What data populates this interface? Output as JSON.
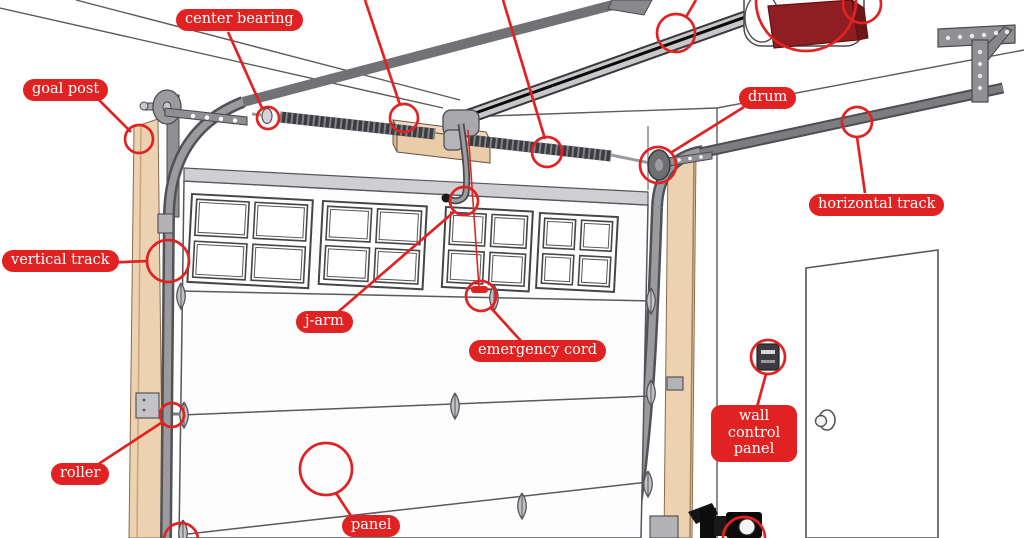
{
  "diagram": {
    "type": "annotated-parts-illustration",
    "labels": {
      "goal_post": "goal post",
      "center_bearing": "center bearing",
      "drum": "drum",
      "horizontal_track": "horizontal track",
      "vertical_track": "vertical track",
      "j_arm": "j-arm",
      "emergency_cord": "emergency cord",
      "roller": "roller",
      "wall_control_panel": "wall control panel",
      "panel": "panel"
    },
    "colors": {
      "annotation_red": "#e02322",
      "wood_tan": "#ecd2b0",
      "metal_gray": "#97979c",
      "dark_metal": "#55555a",
      "opener_maroon": "#8e1e22"
    }
  }
}
